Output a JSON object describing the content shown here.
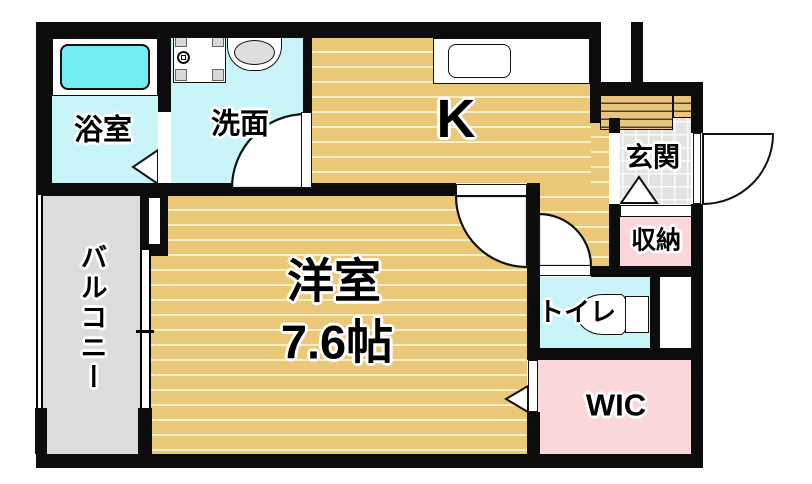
{
  "floorplan": {
    "type": "apartment-floor-plan",
    "rooms": {
      "bathroom": {
        "label": "浴室"
      },
      "washroom": {
        "label": "洗面"
      },
      "kitchen": {
        "label": "K"
      },
      "entrance": {
        "label": "玄関"
      },
      "storage": {
        "label": "収納"
      },
      "toilet": {
        "label": "トイレ"
      },
      "wic": {
        "label": "WIC"
      },
      "western_room": {
        "label": "洋室",
        "size": "7.6帖"
      },
      "balcony": {
        "label": "バルコニー"
      }
    },
    "fixtures": [
      "bathtub",
      "washing-machine-pan",
      "washbasin",
      "kitchen-sink",
      "toilet-bowl"
    ],
    "colors": {
      "wall": "#0c0c0c",
      "wood_floor": "#ebc878",
      "wood_stripe": "#f6eec6",
      "wet_area_floor": "#c9f4f8",
      "bathtub_fill": "#72eef2",
      "closet_pink": "#fcd7da",
      "balcony_gray": "#dcdcdc",
      "entrance_tile": "#e3e3e3"
    }
  }
}
